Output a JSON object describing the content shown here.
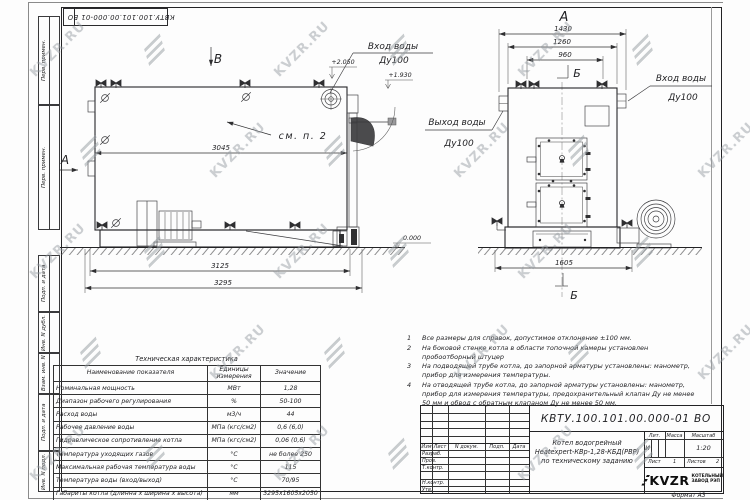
{
  "header_stamp": {
    "number": "КВТУ.100.101.00.000-01 ВО"
  },
  "margins": [
    "Перв. примен.",
    "Перв. примен.",
    "Подп. и дата",
    "Инв. N дубл.",
    "Взам. инв. N",
    "Подп. и дата",
    "Инв. N подл."
  ],
  "side": {
    "label_a": "А",
    "label_v": "В",
    "see_note": "см. п. 2",
    "dim_body": "3045",
    "dim_frame": "3125",
    "dim_overall": "3295",
    "elev_inlet": "+2.050",
    "elev_outlet": "+1.930",
    "elev_ground": "0.000",
    "inlet_line1": "Вход воды",
    "inlet_line2": "Ду100"
  },
  "front": {
    "label_a": "А",
    "label_b_top": "Б",
    "label_b_bottom": "Б",
    "dim_overall": "1430",
    "dim_body": "1260",
    "dim_valves": "960",
    "dim_width": "1605",
    "outlet_line1": "Выход воды",
    "outlet_line2": "Ду100",
    "inlet_line1": "Вход воды",
    "inlet_line2": "Ду100"
  },
  "table": {
    "title": "Техническая характеристика",
    "headers": [
      "Наименование показателя",
      "Единицы измерения",
      "Значение"
    ],
    "rows": [
      {
        "name": "Номинальная мощность",
        "unit": "МВт",
        "value": "1,28"
      },
      {
        "name": "Диапазон рабочего регулирования",
        "unit": "%",
        "value": "50-100"
      },
      {
        "name": "Расход воды",
        "unit": "м3/ч",
        "value": "44"
      },
      {
        "name": "Рабочее давление воды",
        "unit": "МПа (кгс/см2)",
        "value": "0,6 (6,0)"
      },
      {
        "name": "Гидравлическое сопротивление котла",
        "unit": "МПа (кгс/см2)",
        "value": "0,06 (0,6)"
      },
      {
        "name": "Температура уходящих газов",
        "unit": "°С",
        "value": "не более 250"
      },
      {
        "name": "Максимальная рабочая температура воды",
        "unit": "°С",
        "value": "115"
      },
      {
        "name": "Температура воды (вход/выход)",
        "unit": "°С",
        "value": "70/95"
      },
      {
        "name": "Габариты котла (длинна х ширина х высота)",
        "unit": "мм",
        "value": "3295х1605х2050"
      }
    ]
  },
  "notes": {
    "items": [
      {
        "n": "1",
        "text": "Все размеры для справок, допустимое отклонение  ±100 мм."
      },
      {
        "n": "2",
        "text": "На боковой стенке котла в области топочной камеры установлен пробоотборный штуцер"
      },
      {
        "n": "3",
        "text": "На  подводящей трубе котла, до запорной арматуры установлены: манометр, прибор для измерения температуры."
      },
      {
        "n": "4",
        "text": "На отводящей трубе котла, до запорной арматуры установлены: манометр, прибор для измерения температуры, предохранительный клапан Ду не менее 50 мм и обвод с обратным клапаном Ду не менее 50 мм."
      }
    ]
  },
  "titleblock": {
    "number": "КВТУ.100.101.00.000-01 ВО",
    "doc_line1": "Котел водогрейный",
    "doc_line2": "Heatexpert-КВр-1,28-КБД(РВР)",
    "doc_line3": "по техническому заданию",
    "col_izm": "Изм",
    "col_list": "Лист",
    "col_ndoc": "N докум.",
    "col_podp": "Подп.",
    "col_data": "Дата",
    "row_razrab": "Разраб.",
    "row_prov": "Пров.",
    "row_tkontr": "Т.контр.",
    "row_nkontr": "Н.контр.",
    "row_utv": "Утв.",
    "lit_label": "Лит.",
    "massa_label": "Масса",
    "masshtab_label": "Масштаб",
    "lit": "И",
    "masshtab": "1:20",
    "list_label": "Лист",
    "list": "1",
    "listov_label": "Листов",
    "listov": "2",
    "brand": "KVZR",
    "brand_sub1": "КОТЕЛЬНЫЙ",
    "brand_sub2": "ЗАВОД РЭП",
    "format": "Формат  А3"
  },
  "watermark": {
    "text": "KVZR.RU",
    "color": "#949ba0"
  }
}
